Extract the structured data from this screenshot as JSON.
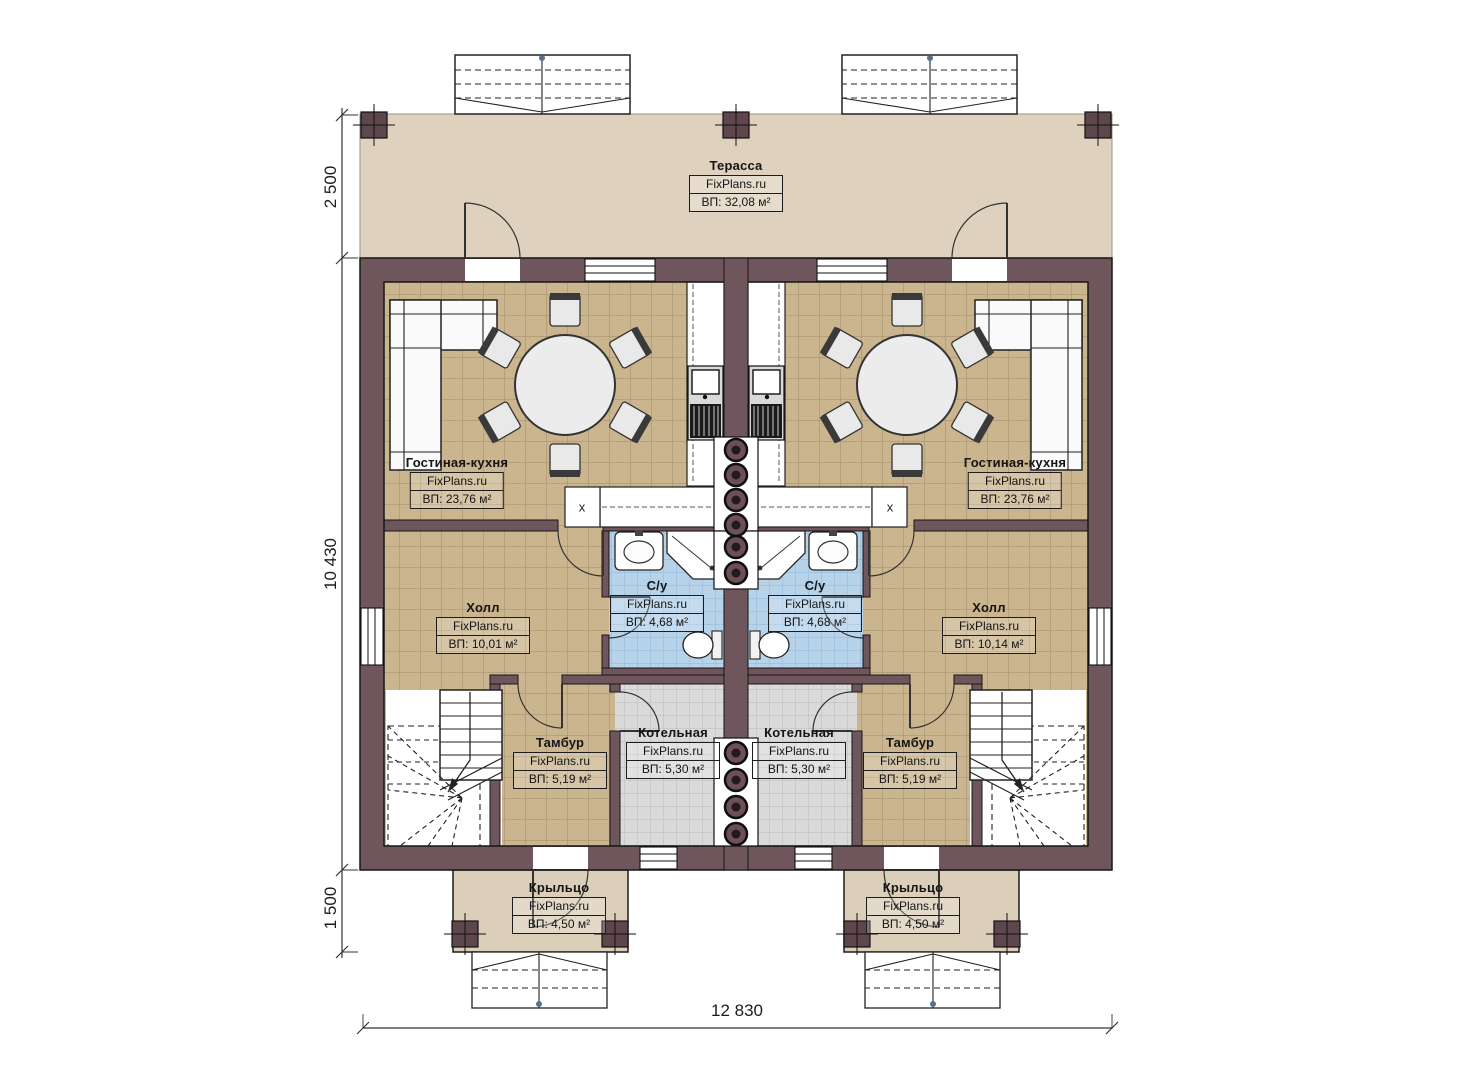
{
  "plan": {
    "brand": "FixPlans.ru",
    "rooms": {
      "terrace": {
        "name": "Терасса",
        "area": "ВП: 32,08 м²"
      },
      "living_left": {
        "name": "Гостиная-кухня",
        "area": "ВП: 23,76 м²"
      },
      "living_right": {
        "name": "Гостиная-кухня",
        "area": "ВП: 23,76 м²"
      },
      "hall_left": {
        "name": "Холл",
        "area": "ВП: 10,01 м²"
      },
      "hall_right": {
        "name": "Холл",
        "area": "ВП: 10,14 м²"
      },
      "bath_left": {
        "name": "С/у",
        "area": "ВП: 4,68 м²"
      },
      "bath_right": {
        "name": "С/у",
        "area": "ВП: 4,68 м²"
      },
      "vestibule_left": {
        "name": "Тамбур",
        "area": "ВП: 5,19 м²"
      },
      "vestibule_right": {
        "name": "Тамбур",
        "area": "ВП: 5,19 м²"
      },
      "boiler_left": {
        "name": "Котельная",
        "area": "ВП: 5,30 м²"
      },
      "boiler_right": {
        "name": "Котельная",
        "area": "ВП: 5,30 м²"
      },
      "porch_left": {
        "name": "Крыльцо",
        "area": "ВП: 4,50 м²"
      },
      "porch_right": {
        "name": "Крыльцо",
        "area": "ВП: 4,50 м²"
      }
    },
    "dimensions": {
      "terrace_depth": "2 500",
      "house_depth": "10 430",
      "porch_depth": "1 500",
      "total_width": "12 830"
    },
    "symbols": {
      "hob": "х"
    },
    "colors": {
      "wall": "#6f565c",
      "floor_tile": "#cbb58f",
      "bath_tile": "#b7d3e9",
      "boiler_tile": "#dadada",
      "terrace": "#ded2bf",
      "porch": "#dccfba",
      "line": "#1c1c1c"
    }
  }
}
